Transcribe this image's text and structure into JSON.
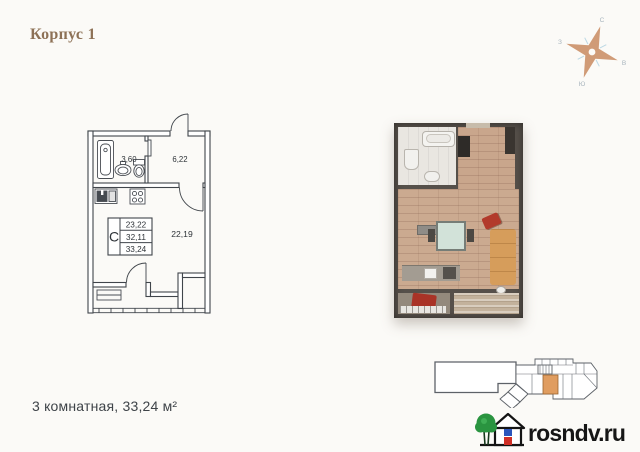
{
  "title": "Корпус 1",
  "compass": {
    "north": "С",
    "east": "В",
    "south": "Ю",
    "west": "З"
  },
  "plan": {
    "bathroom_area": "3,60",
    "hallway_area": "6,22",
    "living_area": "22,19",
    "spec": {
      "letter": "С",
      "rows": [
        "23,22",
        "32,11",
        "33,24"
      ]
    }
  },
  "caption": "3 комнатная, 33,24 м²",
  "brand": {
    "site": "rosndv.ru"
  },
  "icons": {
    "compass": "compass-rose-icon",
    "logo": "house-tree-icon"
  },
  "colors": {
    "title_text": "#8d7156",
    "compass_star": "#d09b77",
    "plan_lines": "#40454b",
    "keyplan_highlight": "#e09d60",
    "wood_floor": "#c9a68c",
    "logo_green": "#2a9440",
    "logo_red": "#cf2f26",
    "logo_blue": "#2b55bb"
  }
}
